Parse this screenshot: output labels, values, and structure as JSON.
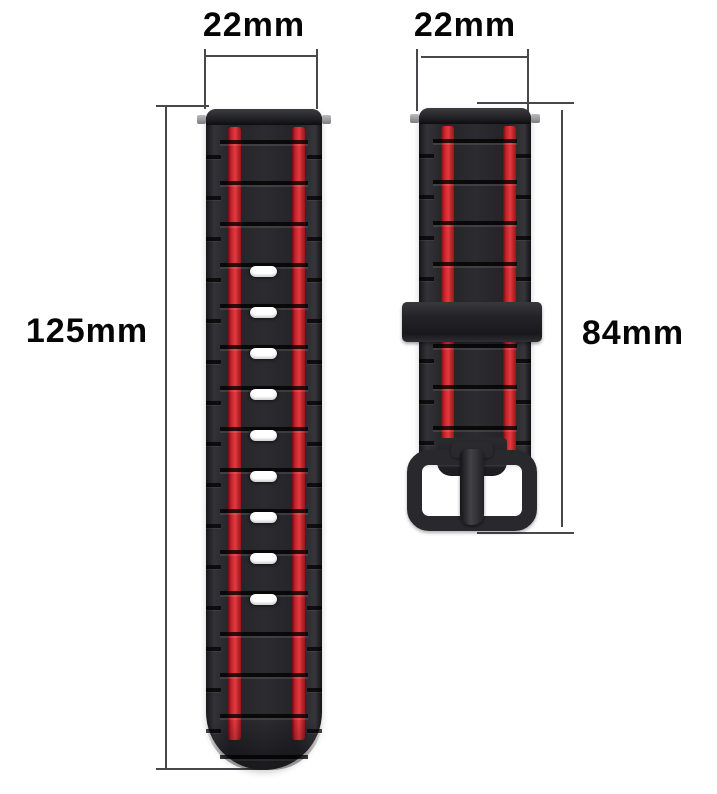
{
  "annotations": {
    "long_strap_width_label": "22mm",
    "short_strap_width_label": "22mm",
    "long_strap_length_label": "125mm",
    "short_strap_length_label": "84mm"
  },
  "straps": {
    "long": {
      "description": "long watch strap half with adjustment holes",
      "hole_count": 9
    },
    "short": {
      "description": "short watch strap half with keeper loop and buckle"
    }
  },
  "colors": {
    "background": "#ffffff",
    "strap_black": "#26262a",
    "stripe_red": "#c8252c",
    "hole_white": "#ffffff",
    "buckle_gray": "#29292d",
    "pin_gray": "#96969a",
    "dimension_line": "#48484c",
    "label_text": "#060606"
  }
}
